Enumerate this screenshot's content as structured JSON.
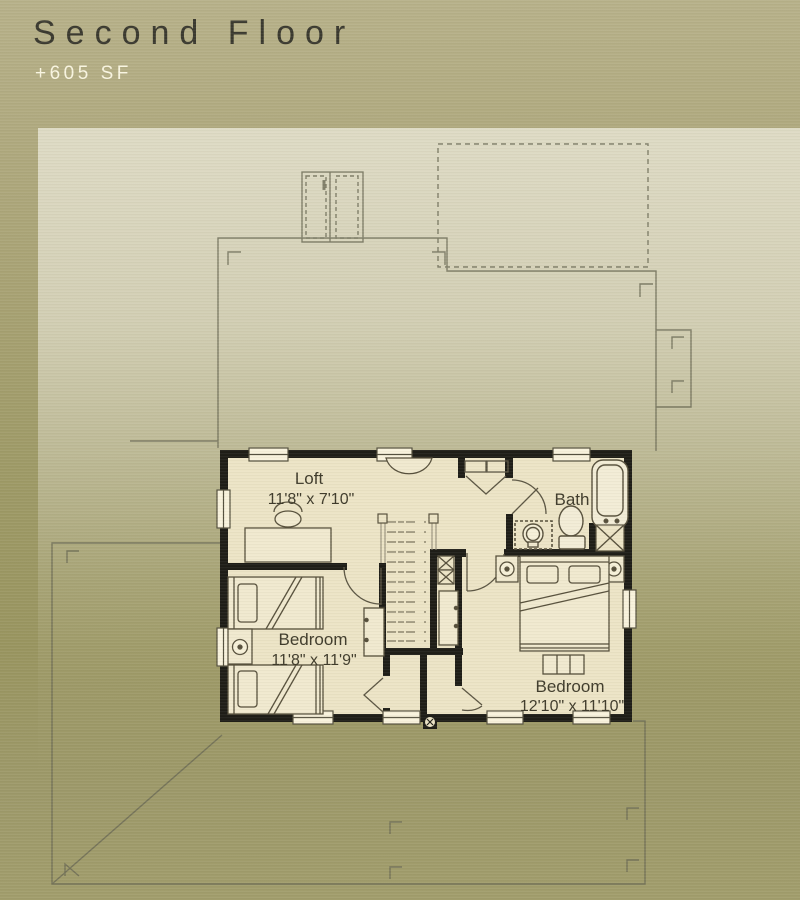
{
  "header": {
    "title": "Second Floor",
    "subtitle": "+605 SF"
  },
  "floor_plan": {
    "rooms": {
      "loft": {
        "name": "Loft",
        "dims": "11'8\" x 7'10\""
      },
      "bath": {
        "name": "Bath"
      },
      "bedroom_left": {
        "name": "Bedroom",
        "dims": "11'8\" x 11'9\""
      },
      "bedroom_right": {
        "name": "Bedroom",
        "dims": "12'10\" x 11'10\""
      }
    },
    "fixtures": [
      "bathtub",
      "toilet",
      "vanity-sink",
      "washer",
      "linen-closet",
      "stairs",
      "desk",
      "desk-chair",
      "twin-bed",
      "twin-bed",
      "nightstand",
      "queen-bed",
      "nightstand",
      "nightstand",
      "bench",
      "wardrobe",
      "wardrobe",
      "console-table"
    ]
  },
  "colors": {
    "background_top": "#b7b18a",
    "background_bottom": "#9d996a",
    "ghost_panel": "#dedbc8",
    "ghost_line": "#6b6a55",
    "wall": "#1e1d17",
    "floor": "#ece4c6",
    "window": "#f8f2dc",
    "furniture_line": "#57503c",
    "title_text": "#3a392f",
    "subtitle_text": "#f9f5e1",
    "label_text": "#3f3b2b"
  }
}
